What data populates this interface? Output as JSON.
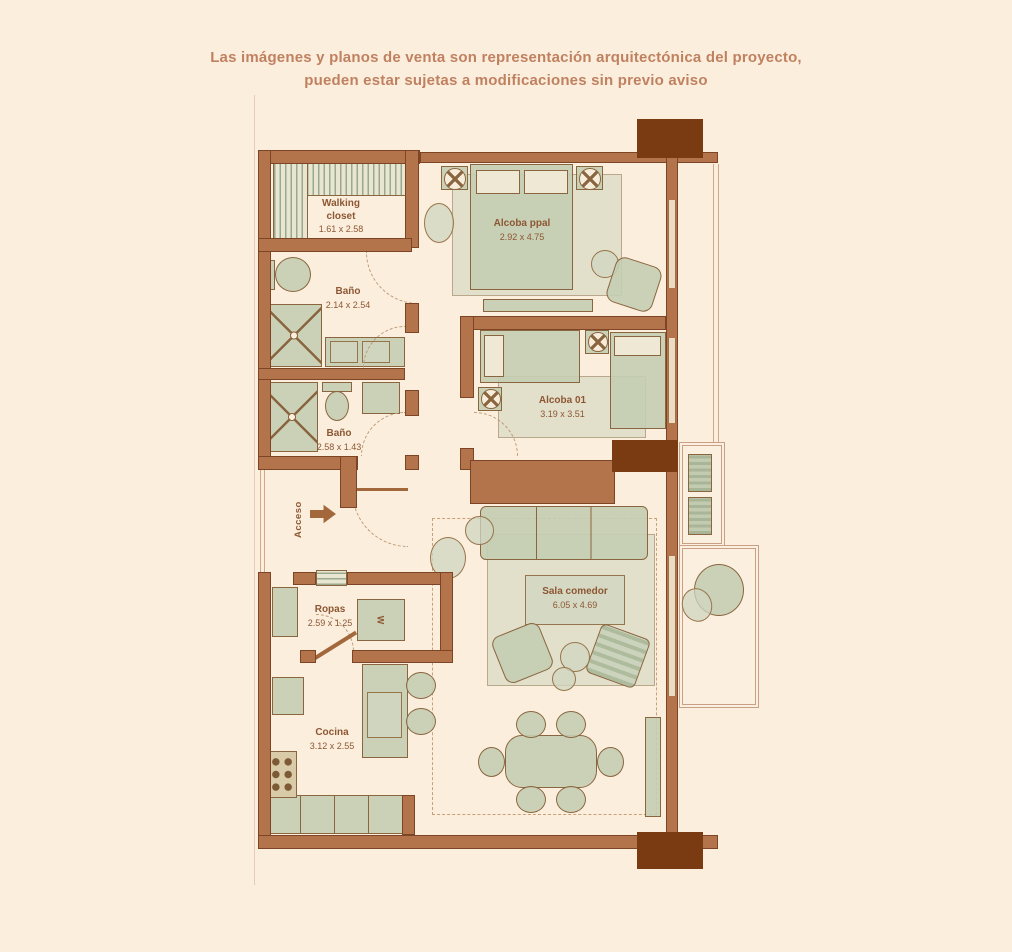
{
  "disclaimer": {
    "line1": "Las imágenes y planos de venta son representación arquitectónica del proyecto,",
    "line2": "pueden estar sujetas a modificaciones sin previo aviso"
  },
  "rooms": [
    {
      "name": "Walking\ncloset",
      "dims": "1.61 x 2.58"
    },
    {
      "name": "Baño",
      "dims": "2.14 x 2.54"
    },
    {
      "name": "Alcoba ppal",
      "dims": "2.92 x 4.75"
    },
    {
      "name": "Alcoba 01",
      "dims": "3.19 x 3.51"
    },
    {
      "name": "Baño",
      "dims": "2.58 x 1.43"
    },
    {
      "name": "Sala comedor",
      "dims": "6.05 x 4.69"
    },
    {
      "name": "Ropas",
      "dims": "2.59 x 1.25"
    },
    {
      "name": "Cocina",
      "dims": "3.12 x 2.55"
    }
  ],
  "labels": {
    "entrance": "Acceso",
    "washer": "W"
  },
  "colors": {
    "background": "#fbeedd",
    "wall": "#b3734b",
    "column": "#7b3b12",
    "furniture": "#c4cdb2",
    "label_text": "#8d5733",
    "disclaimer_text": "#c08160"
  }
}
